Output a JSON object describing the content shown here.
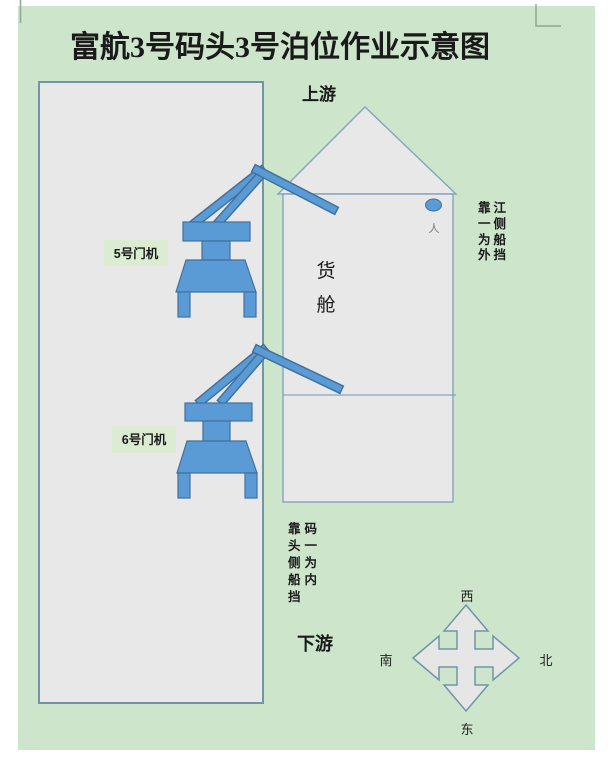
{
  "page": {
    "title": "富航3号码头3号泊位作业示意图"
  },
  "orientation": {
    "upstream": "上游",
    "downstream": "下游"
  },
  "ship": {
    "cargo_hold_char_top": "货",
    "cargo_hold_char_bottom": "舱",
    "person_label": "人"
  },
  "cranes": {
    "crane5_label": "5号门机",
    "crane6_label": "6号门机"
  },
  "notes": {
    "river_side_lines": [
      "靠江",
      "一侧",
      "为船",
      "外挡"
    ],
    "dock_side_lines": [
      "靠码",
      "头一",
      "侧为",
      "船内",
      "挡"
    ]
  },
  "compass": {
    "top": "西",
    "left": "南",
    "right": "北",
    "bottom": "东"
  },
  "colors": {
    "page_background": "#cde5cb",
    "shape_fill": "#e8e8e8",
    "dock_border": "#6e96a6",
    "ship_border": "#85a4bd",
    "crane_fill": "#5b9bd5",
    "crane_border": "#41719c",
    "label_box_fill": "#dcecd3",
    "corner_mark": "#94a594"
  }
}
